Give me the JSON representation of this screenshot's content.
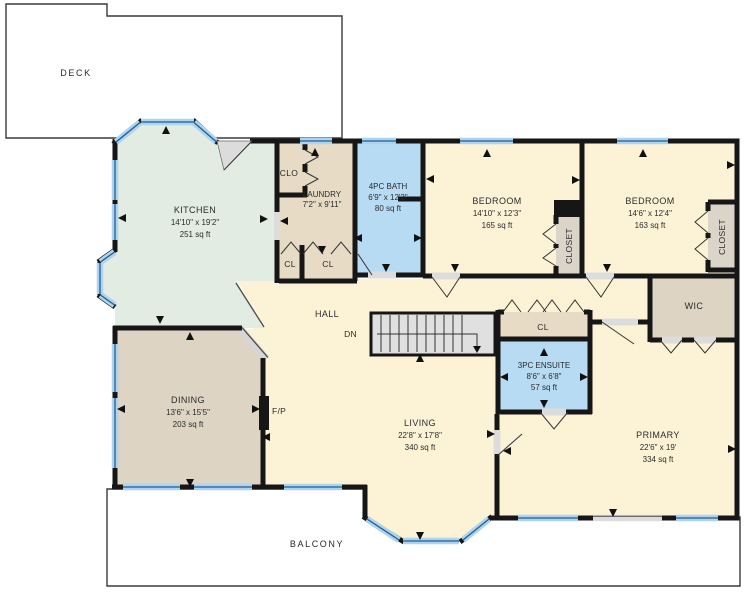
{
  "plan": {
    "type": "residential-floor-plan",
    "rooms": {
      "deck": {
        "name": "DECK"
      },
      "kitchen": {
        "name": "KITCHEN",
        "dims": "14'10\" x 19'2\"",
        "area": "251 sq ft"
      },
      "clo": {
        "name": "CLO"
      },
      "laundry": {
        "name": "LAUNDRY",
        "dims": "7'2\" x 9'11\""
      },
      "cl_a": {
        "name": "CL"
      },
      "cl_b": {
        "name": "CL"
      },
      "bath": {
        "name": "4PC BATH",
        "dims": "6'9\" x 12'3\"",
        "area": "80 sq ft"
      },
      "bedroom1": {
        "name": "BEDROOM",
        "dims": "14'10\" x 12'3\"",
        "area": "165 sq ft"
      },
      "closet1": {
        "name": "CLOSET"
      },
      "bedroom2": {
        "name": "BEDROOM",
        "dims": "14'6\" x 12'4\"",
        "area": "163 sq ft"
      },
      "closet2": {
        "name": "CLOSET"
      },
      "wic": {
        "name": "WIC"
      },
      "hall": {
        "name": "HALL"
      },
      "cl_hall": {
        "name": "CL"
      },
      "ensuite": {
        "name": "3PC ENSUITE",
        "dims": "8'6\" x 6'8\"",
        "area": "57 sq ft"
      },
      "dining": {
        "name": "DINING",
        "dims": "13'6\" x 15'5\"",
        "area": "203 sq ft"
      },
      "living": {
        "name": "LIVING",
        "dims": "22'8\" x 17'8\"",
        "area": "340 sq ft"
      },
      "primary": {
        "name": "PRIMARY",
        "dims": "22'6\" x 19'",
        "area": "334 sq ft"
      },
      "balcony": {
        "name": "BALCONY"
      }
    },
    "annotations": {
      "stairs_down": "DN",
      "fireplace": "F/P"
    },
    "colors": {
      "wall": "#161616",
      "floor_cream": "#fcf3d7",
      "kitchen_mint": "#e2ece3",
      "closet_tan": "#e7dbc5",
      "dining_tan": "#ddd4c4",
      "bath_blue": "#b7dbf3",
      "window_blue": "#aed3ee",
      "window_frame": "#1e5d92",
      "stairs_gray": "#e0e0e0",
      "door_gray": "#dcdcdc",
      "outdoor_white": "#ffffff"
    }
  }
}
